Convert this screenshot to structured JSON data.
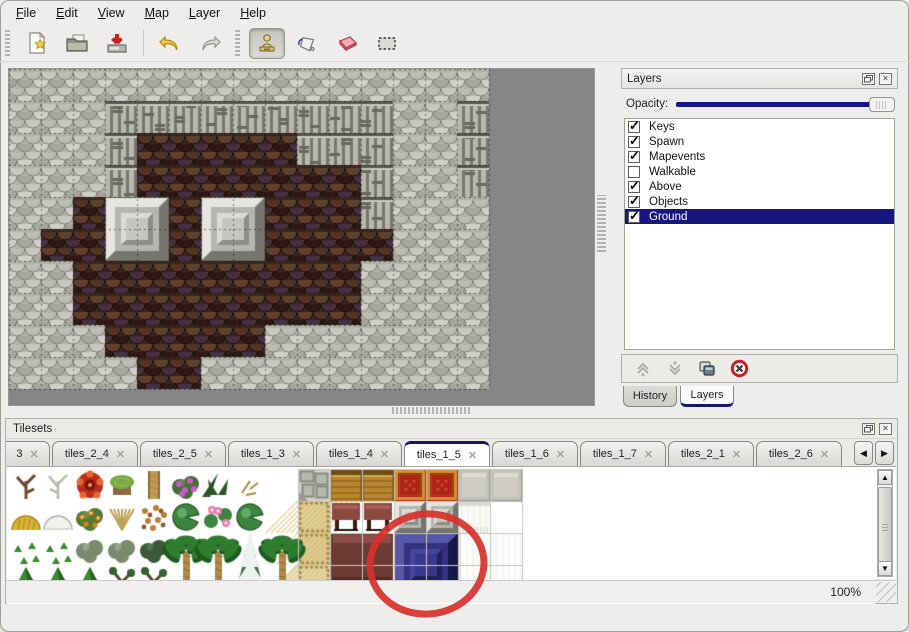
{
  "menu": {
    "items": [
      "File",
      "Edit",
      "View",
      "Map",
      "Layer",
      "Help"
    ]
  },
  "toolbar": {
    "buttons": [
      "new",
      "open",
      "save",
      "undo",
      "redo",
      "stamp",
      "fill",
      "eraser",
      "select"
    ],
    "active_tool": "stamp"
  },
  "layers_panel": {
    "title": "Layers",
    "opacity_label": "Opacity:",
    "opacity_percent": 100,
    "layers": [
      {
        "name": "Keys",
        "checked": true,
        "selected": false
      },
      {
        "name": "Spawn",
        "checked": true,
        "selected": false
      },
      {
        "name": "Mapevents",
        "checked": true,
        "selected": false
      },
      {
        "name": "Walkable",
        "checked": false,
        "selected": false
      },
      {
        "name": "Above",
        "checked": true,
        "selected": false
      },
      {
        "name": "Objects",
        "checked": true,
        "selected": false
      },
      {
        "name": "Ground",
        "checked": true,
        "selected": true
      }
    ],
    "tabs": [
      {
        "label": "History",
        "active": false
      },
      {
        "label": "Layers",
        "active": true
      }
    ]
  },
  "tilesets_panel": {
    "title": "Tilesets",
    "tabs": [
      {
        "label": "3",
        "cut": true,
        "active": false
      },
      {
        "label": "tiles_2_4",
        "active": false
      },
      {
        "label": "tiles_2_5",
        "active": false
      },
      {
        "label": "tiles_1_3",
        "active": false
      },
      {
        "label": "tiles_1_4",
        "active": false
      },
      {
        "label": "tiles_1_5",
        "active": true
      },
      {
        "label": "tiles_1_6",
        "active": false
      },
      {
        "label": "tiles_1_7",
        "active": false
      },
      {
        "label": "tiles_2_1",
        "active": false
      },
      {
        "label": "tiles_2_6",
        "active": false
      }
    ],
    "close_glyph": "✕",
    "scroll_left": "◀",
    "scroll_right": "▶"
  },
  "status_bar": {
    "zoom": "100%"
  },
  "map": {
    "tile_size": 32,
    "rows": [
      "GGGGGGGGGGGGGGG",
      "GGGCCCCCCCCCGGC",
      "GGGCBBBBBCCCGGC",
      "GGGCBBBBBBBCGGC",
      "GGBBBBBBBBBCGGG",
      "GBBBBBBBBBBBGGG",
      "GGBBBBBBBBBGGGG",
      "GGBBBBBBBBBGGGG",
      "GGGBBBBBGGGGGGG",
      "GGGGBBGGGGGGGGG"
    ],
    "legend": {
      "G": "gray-rock",
      "C": "cliff-face",
      "B": "brown-floor"
    },
    "pedestals": [
      {
        "col": 3,
        "row": 4
      },
      {
        "col": 6,
        "row": 4
      }
    ]
  },
  "tileset_content": {
    "tile_size": 32,
    "rows": [
      [
        "dead",
        "pale",
        "redflower",
        "stump",
        "trunk",
        "purplebush",
        "fern",
        "twig",
        "",
        "stone",
        "wood",
        "wood",
        "carpet",
        "carpet",
        "graytile",
        "graytile"
      ],
      [
        "hay",
        "snowmound",
        "oflowers",
        "drygrass",
        "leaves",
        "lily",
        "lilypink",
        "lily",
        "",
        "mat",
        "maroonstool",
        "maroonstool",
        "grayblock",
        "grayblock",
        "curtaintop",
        "white"
      ],
      [
        "sprouts",
        "sprouts",
        "bushg",
        "bushg",
        "bushd",
        "",
        "",
        "",
        "",
        "mat",
        "",
        "",
        "",
        "",
        "",
        ""
      ],
      [
        "cone",
        "cone",
        "cone",
        "gnarl",
        "gnarl",
        "",
        "",
        "",
        "",
        "mat",
        "",
        "",
        "",
        "",
        "",
        ""
      ]
    ],
    "tall_trees": [
      {
        "col": 5,
        "type": "palm"
      },
      {
        "col": 6,
        "type": "palm"
      },
      {
        "col": 7,
        "type": "pinesnow"
      },
      {
        "col": 8,
        "type": "palm"
      }
    ],
    "big_blocks": [
      {
        "type": "maroontable",
        "col": 10,
        "row": 2,
        "w": 2,
        "h": 2
      },
      {
        "type": "blueblock",
        "col": 12,
        "row": 2,
        "w": 2,
        "h": 2
      },
      {
        "type": "curtain",
        "col": 14,
        "row": 2,
        "w": 2,
        "h": 2
      }
    ],
    "annotation": {
      "type": "red-circle",
      "cx": 427,
      "cy": 564,
      "rx": 57,
      "ry": 50,
      "rotate": -6,
      "stroke": "#d7312b",
      "stroke_width": 7
    }
  },
  "colors": {
    "accent_navy": "#14148c",
    "selection_navy": "#16167e",
    "annotation_red": "#d7312b",
    "map_background": "#868686",
    "window_background": "#eeedeb"
  }
}
